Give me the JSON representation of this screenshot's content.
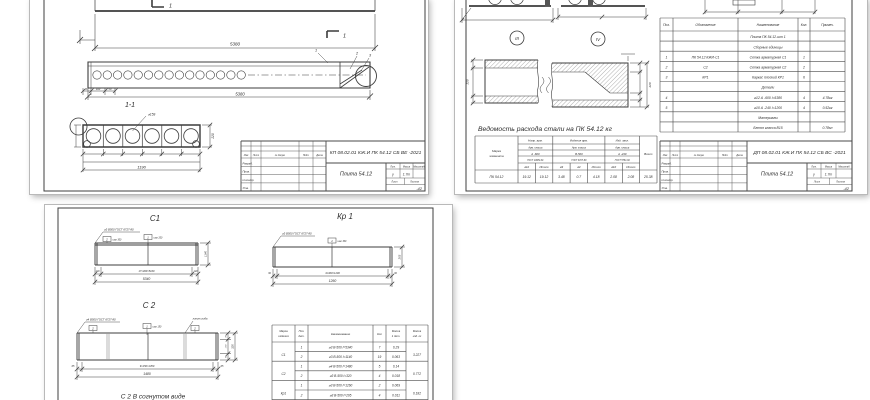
{
  "titleblocks": {
    "sheet1_code": "КП 08.02.01 КЖ.И ПК 54.12 СБ ВЕ -2021",
    "sheet2_code": "ДП 08.02.01 КЖ.И ПК 54.12 СБ ВС -2021",
    "title": "Плита 54.12",
    "stamp_cols": [
      "Изм",
      "Лист",
      "№ докум.",
      "Подп.",
      "Дата"
    ],
    "stamp_rows": [
      "Разраб.",
      "Пров.",
      "Н.контр.",
      "Утв."
    ],
    "lit_label": "Лит.",
    "mass_label": "Масса",
    "scale_label": "Масштаб",
    "lit_value": "у",
    "mass_value": "1.7т",
    "list_label": "Лист",
    "listov_label": "Листов",
    "group": "-42"
  },
  "sheet1": {
    "plan_dim_total": "5380",
    "section_mark": "1",
    "view_label": "1-1",
    "mid_dims": [
      "60",
      "100",
      "50"
    ],
    "mid_dim_total": "5380",
    "callouts": [
      "1",
      "2",
      "3"
    ],
    "void_dia": "⌀159",
    "sec_height": "220",
    "sec_width": "1190"
  },
  "sheet2": {
    "detail_labels": [
      "III",
      "IV"
    ],
    "det_height": "220",
    "steel_heading": "Ведомость расхода стали на ПК 54.12 кг",
    "steel_table": {
      "marka_header": [
        "Марка",
        "элемента"
      ],
      "groups": [
        "Напр. арм.",
        "Изделия арм.",
        "Изд. закл."
      ],
      "arm_class": "Арм. класса",
      "classes": [
        "А -600",
        "В-500",
        "А -240"
      ],
      "gosts": [
        "ГОСТ 10884-81",
        "ГОСТ 6727-80",
        "ГОСТ 5781-82"
      ],
      "dia_cols": [
        "⌀12",
        "Итого",
        "⌀3",
        "⌀4",
        "Итого",
        "⌀10",
        "Итого"
      ],
      "total_header": "Всего",
      "row_marka": "ПК 54.12",
      "row_values": [
        "19.12",
        "19.12",
        "3.48",
        "0.7",
        "4.18",
        "2.08",
        "2.08",
        "25.38"
      ]
    },
    "spec_table": {
      "headers": [
        "Поз.",
        "Обозначение",
        "Наименование",
        "Кол.",
        "Примеч."
      ],
      "rows": [
        {
          "pos": "",
          "oboz": "",
          "name": "Плита ПК 54.12-шт 1",
          "kol": "",
          "prim": ""
        },
        {
          "pos": "",
          "oboz": "",
          "name": "Сборные единицы",
          "kol": "",
          "prim": ""
        },
        {
          "pos": "1",
          "oboz": "ПК 54.12 КЖИ-С1",
          "name": "Сетка арматурная С1",
          "kol": "1",
          "prim": ""
        },
        {
          "pos": "2",
          "oboz": "С2",
          "name": "Сетка арматурная С2",
          "kol": "2",
          "prim": ""
        },
        {
          "pos": "3",
          "oboz": "КР1",
          "name": "Каркас плоский КР1",
          "kol": "6",
          "prim": ""
        },
        {
          "pos": "",
          "oboz": "",
          "name": "Детали",
          "kol": "",
          "prim": ""
        },
        {
          "pos": "4",
          "oboz": "",
          "name": "⌀12 А -600  l=5380",
          "kol": "4",
          "prim": "4.78кг"
        },
        {
          "pos": "5",
          "oboz": "",
          "name": "⌀10 А -240  l=1200",
          "kol": "4",
          "prim": "0.52кг"
        },
        {
          "pos": "",
          "oboz": "",
          "name": "Материалы",
          "kol": "",
          "prim": ""
        },
        {
          "pos": "",
          "oboz": "",
          "name": "Бетон класса В15",
          "kol": "",
          "prim": "0.78м³"
        }
      ]
    }
  },
  "sheet3": {
    "labels": {
      "c1": "С1",
      "kr1": "Кр 1",
      "c2": "С 2",
      "c2_bent": "С 2 В согнутом виде"
    },
    "c1": {
      "note": "⌀3 В500 ГОСТ 6727-80",
      "flag1": "2",
      "note1": "шаг 300",
      "flag2": "1",
      "note2": "шаг 200",
      "dim_edge": "120",
      "dim_mid": "17×300=5100",
      "dim_total": "5340",
      "dim_side": "1140"
    },
    "kr1": {
      "note": "⌀3 В500 ГОСТ 6727-80",
      "flag1": "1",
      "note1": "шаг 300",
      "dim_edge": "30",
      "dim_mid": "4×300=1200",
      "dim_total": "1260",
      "dim_side": "205"
    },
    "c2": {
      "note": "⌀4 В500 ГОСТ 6727-80",
      "flag1": "2",
      "flag2": "1",
      "flag3": "2",
      "flag_note": "шаг 150",
      "bend_note": "линия сгиба",
      "dim_edge": "65",
      "dim_mid": "9×150=1350",
      "dim_total": "1480",
      "side1": "75",
      "side2": "170",
      "side3": "75",
      "side_total": "320"
    },
    "table": {
      "h_marka1": "Марка",
      "h_marka2": "изделия",
      "h_poz1": "Поз.",
      "h_poz2": "дет.",
      "h_name": "Наименование",
      "h_kol": "Кол",
      "h_m1a": "Масса",
      "h_m1b": "1 дет.",
      "h_m2a": "Масса",
      "h_m2b": "изд. кг",
      "groups": [
        {
          "marka": "С1",
          "mass": "3.227",
          "rows": [
            {
              "pos": "1",
              "name": "⌀3 В-500  l=5340",
              "kol": "7",
              "m1": "0.29"
            },
            {
              "pos": "2",
              "name": "⌀3 В-500  l=1140",
              "kol": "19",
              "m1": "0.063"
            }
          ]
        },
        {
          "marka": "С2",
          "mass": "0.772",
          "rows": [
            {
              "pos": "1",
              "name": "⌀4 В-500  l=1480",
              "kol": "5",
              "m1": "0.14"
            },
            {
              "pos": "2",
              "name": "⌀3 В-500  l=320",
              "kol": "4",
              "m1": "0.018"
            }
          ]
        },
        {
          "marka": "Кр1",
          "mass": "0.182",
          "rows": [
            {
              "pos": "1",
              "name": "⌀3 В-500  l=1260",
              "kol": "2",
              "m1": "0.069"
            },
            {
              "pos": "2",
              "name": "⌀3 В-500  l=205",
              "kol": "4",
              "m1": "0.011"
            }
          ]
        }
      ]
    }
  }
}
